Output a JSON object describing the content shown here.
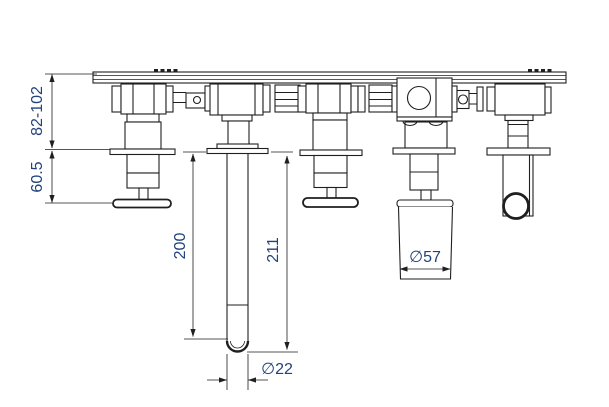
{
  "dimensions": {
    "mount_depth": "82-102",
    "handle_projection": "60.5",
    "spout_length_to_tip": "200",
    "spout_length_total": "211",
    "knob_diameter": "∅57",
    "spout_tube_diameter": "∅22"
  },
  "colors": {
    "line": "#1f1f1f",
    "dimension_text": "#21427a",
    "background": "#ffffff"
  }
}
